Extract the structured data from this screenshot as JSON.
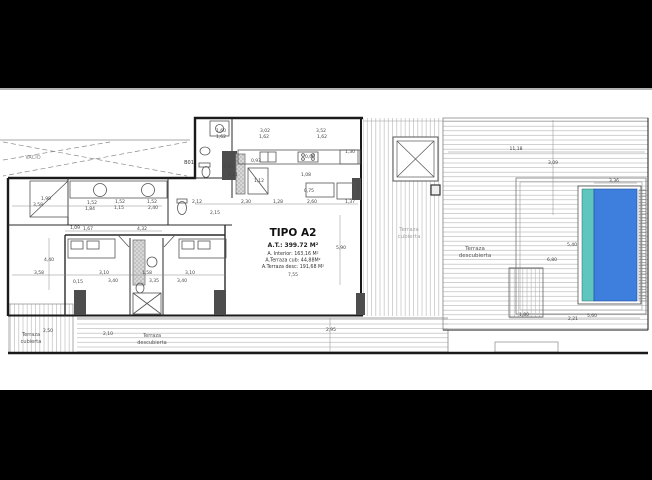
{
  "drawing": {
    "type": "architectural-floor-plan",
    "unit_label": "TIPO A2"
  },
  "colors": {
    "background": "#000000",
    "paper": "#ffffff",
    "wall": "#1a1a1a",
    "thin_line": "#777777",
    "hatch": "#b3b3b3",
    "dim_text": "#444444",
    "faint_text": "#a3a3a3",
    "pool_blue": "#3e7edd",
    "pool_teal": "#5fc6bf",
    "wall_block": "#4d4d4d"
  },
  "title_block": {
    "title": "TIPO A2",
    "total_area": "A.T.: 399.72 M²",
    "interior": "A. Interior: 163,16 M²",
    "terrace_covered": "A.Terraza cub: 44,88M²",
    "terrace_open": "A.Terraza desc: 191,68 M²"
  },
  "labels": [
    {
      "text": "VACIO",
      "x": 33,
      "y": 159,
      "size": 5,
      "color": "#888888",
      "weight": "normal"
    },
    {
      "text": "B01",
      "x": 189,
      "y": 164,
      "size": 5,
      "color": "#333333",
      "weight": "normal"
    },
    {
      "text": "Terraza",
      "x": 409,
      "y": 231,
      "size": 5.5,
      "color": "#a3a3a3",
      "weight": "normal"
    },
    {
      "text": "cubierta",
      "x": 409,
      "y": 238,
      "size": 5.5,
      "color": "#a3a3a3",
      "weight": "normal"
    },
    {
      "text": "Terraza",
      "x": 475,
      "y": 250,
      "size": 5.5,
      "color": "#555555",
      "weight": "normal"
    },
    {
      "text": "descubierta",
      "x": 475,
      "y": 257,
      "size": 5.5,
      "color": "#555555",
      "weight": "normal"
    },
    {
      "text": "Terraza",
      "x": 31,
      "y": 336,
      "size": 5,
      "color": "#555555",
      "weight": "normal"
    },
    {
      "text": "cubierta",
      "x": 31,
      "y": 343,
      "size": 5,
      "color": "#555555",
      "weight": "normal"
    },
    {
      "text": "Terraza",
      "x": 152,
      "y": 337,
      "size": 5,
      "color": "#555555",
      "weight": "normal"
    },
    {
      "text": "descubierta",
      "x": 152,
      "y": 344,
      "size": 5,
      "color": "#555555",
      "weight": "normal"
    },
    {
      "text": "TIPO A2",
      "x": 293,
      "y": 236,
      "size": 10.5,
      "color": "#111111",
      "weight": "bold"
    },
    {
      "text": "A.T.: 399.72 M²",
      "x": 293,
      "y": 247,
      "size": 6,
      "color": "#222222",
      "weight": "bold"
    },
    {
      "text": "A. Interior: 163,16 M²",
      "x": 293,
      "y": 255,
      "size": 4.8,
      "color": "#333333",
      "weight": "normal"
    },
    {
      "text": "A.Terraza cub: 44,88M²",
      "x": 293,
      "y": 261.5,
      "size": 4.8,
      "color": "#333333",
      "weight": "normal"
    },
    {
      "text": "A.Terraza desc: 191,68 M²",
      "x": 293,
      "y": 268,
      "size": 4.8,
      "color": "#333333",
      "weight": "normal"
    },
    {
      "text": "7,55",
      "x": 293,
      "y": 276,
      "size": 4.5,
      "color": "#444444",
      "weight": "normal"
    },
    {
      "text": "1,99",
      "x": 46,
      "y": 200,
      "size": 4.5,
      "color": "#444444",
      "weight": "normal"
    },
    {
      "text": "3,58",
      "x": 38,
      "y": 206,
      "size": 4.5,
      "color": "#444444",
      "weight": "normal"
    },
    {
      "text": "1,52",
      "x": 92,
      "y": 204,
      "size": 4.5,
      "color": "#444444",
      "weight": "normal"
    },
    {
      "text": "1,84",
      "x": 90,
      "y": 210,
      "size": 4.5,
      "color": "#444444",
      "weight": "normal"
    },
    {
      "text": "1,52",
      "x": 120,
      "y": 203,
      "size": 4.5,
      "color": "#444444",
      "weight": "normal"
    },
    {
      "text": "1,15",
      "x": 119,
      "y": 209,
      "size": 4.5,
      "color": "#444444",
      "weight": "normal"
    },
    {
      "text": "1,52",
      "x": 152,
      "y": 203,
      "size": 4.5,
      "color": "#444444",
      "weight": "normal"
    },
    {
      "text": "2,40",
      "x": 153,
      "y": 209,
      "size": 4.5,
      "color": "#444444",
      "weight": "normal"
    },
    {
      "text": "1,60",
      "x": 221,
      "y": 132,
      "size": 4.5,
      "color": "#444444",
      "weight": "normal"
    },
    {
      "text": "1,62",
      "x": 221,
      "y": 138,
      "size": 4.5,
      "color": "#444444",
      "weight": "normal"
    },
    {
      "text": "3,02",
      "x": 265,
      "y": 132,
      "size": 4.5,
      "color": "#444444",
      "weight": "normal"
    },
    {
      "text": "1,62",
      "x": 264,
      "y": 138,
      "size": 4.5,
      "color": "#444444",
      "weight": "normal"
    },
    {
      "text": "3,52",
      "x": 321,
      "y": 132,
      "size": 4.5,
      "color": "#444444",
      "weight": "normal"
    },
    {
      "text": "1,62",
      "x": 322,
      "y": 138,
      "size": 4.5,
      "color": "#444444",
      "weight": "normal"
    },
    {
      "text": "1,30",
      "x": 350,
      "y": 153,
      "size": 4.5,
      "color": "#444444",
      "weight": "normal"
    },
    {
      "text": "0,60",
      "x": 310,
      "y": 158,
      "size": 4.5,
      "color": "#444444",
      "weight": "normal"
    },
    {
      "text": "0,93",
      "x": 256,
      "y": 162,
      "size": 4.5,
      "color": "#444444",
      "weight": "normal"
    },
    {
      "text": "2,05",
      "x": 228,
      "y": 168,
      "size": 4.5,
      "color": "#444444",
      "weight": "normal"
    },
    {
      "text": "2,21",
      "x": 233,
      "y": 176,
      "size": 4.5,
      "color": "#444444",
      "weight": "normal"
    },
    {
      "text": "1,12",
      "x": 259,
      "y": 182,
      "size": 4.5,
      "color": "#444444",
      "weight": "normal"
    },
    {
      "text": "1,08",
      "x": 306,
      "y": 176,
      "size": 4.5,
      "color": "#444444",
      "weight": "normal"
    },
    {
      "text": "0,75",
      "x": 309,
      "y": 192,
      "size": 4.5,
      "color": "#444444",
      "weight": "normal"
    },
    {
      "text": "2,12",
      "x": 197,
      "y": 203,
      "size": 4.5,
      "color": "#444444",
      "weight": "normal"
    },
    {
      "text": "2,30",
      "x": 246,
      "y": 203,
      "size": 4.5,
      "color": "#444444",
      "weight": "normal"
    },
    {
      "text": "1,28",
      "x": 278,
      "y": 203,
      "size": 4.5,
      "color": "#444444",
      "weight": "normal"
    },
    {
      "text": "2,60",
      "x": 312,
      "y": 203,
      "size": 4.5,
      "color": "#444444",
      "weight": "normal"
    },
    {
      "text": "1,37",
      "x": 350,
      "y": 203,
      "size": 4.5,
      "color": "#444444",
      "weight": "normal"
    },
    {
      "text": "2,15",
      "x": 215,
      "y": 214,
      "size": 4.5,
      "color": "#444444",
      "weight": "normal"
    },
    {
      "text": "5,90",
      "x": 341,
      "y": 249,
      "size": 4.5,
      "color": "#444444",
      "weight": "normal"
    },
    {
      "text": "1,09",
      "x": 75,
      "y": 229,
      "size": 4.5,
      "color": "#444444",
      "weight": "normal"
    },
    {
      "text": "1,67",
      "x": 88,
      "y": 230,
      "size": 4.5,
      "color": "#444444",
      "weight": "normal"
    },
    {
      "text": "4,32",
      "x": 142,
      "y": 230,
      "size": 4.5,
      "color": "#444444",
      "weight": "normal"
    },
    {
      "text": "4,40",
      "x": 49,
      "y": 261,
      "size": 4.5,
      "color": "#444444",
      "weight": "normal"
    },
    {
      "text": "3,58",
      "x": 39,
      "y": 274,
      "size": 4.5,
      "color": "#444444",
      "weight": "normal"
    },
    {
      "text": "3,10",
      "x": 104,
      "y": 274,
      "size": 4.5,
      "color": "#444444",
      "weight": "normal"
    },
    {
      "text": "3,40",
      "x": 113,
      "y": 282,
      "size": 4.5,
      "color": "#444444",
      "weight": "normal"
    },
    {
      "text": "1,58",
      "x": 147,
      "y": 274,
      "size": 4.5,
      "color": "#444444",
      "weight": "normal"
    },
    {
      "text": "3,35",
      "x": 154,
      "y": 282,
      "size": 4.5,
      "color": "#444444",
      "weight": "normal"
    },
    {
      "text": "0,15",
      "x": 78,
      "y": 283,
      "size": 4.5,
      "color": "#444444",
      "weight": "normal"
    },
    {
      "text": "3,10",
      "x": 190,
      "y": 274,
      "size": 4.5,
      "color": "#444444",
      "weight": "normal"
    },
    {
      "text": "3,40",
      "x": 182,
      "y": 282,
      "size": 4.5,
      "color": "#444444",
      "weight": "normal"
    },
    {
      "text": "2,50",
      "x": 48,
      "y": 332,
      "size": 4.5,
      "color": "#444444",
      "weight": "normal"
    },
    {
      "text": "2,10",
      "x": 108,
      "y": 335,
      "size": 4.5,
      "color": "#444444",
      "weight": "normal"
    },
    {
      "text": "2,95",
      "x": 331,
      "y": 331,
      "size": 4.5,
      "color": "#444444",
      "weight": "normal"
    },
    {
      "text": "11,18",
      "x": 516,
      "y": 150,
      "size": 4.5,
      "color": "#444444",
      "weight": "normal"
    },
    {
      "text": "3,09",
      "x": 553,
      "y": 164,
      "size": 4.5,
      "color": "#444444",
      "weight": "normal"
    },
    {
      "text": "3,36",
      "x": 614,
      "y": 182,
      "size": 4.5,
      "color": "#444444",
      "weight": "normal"
    },
    {
      "text": "5,40",
      "x": 572,
      "y": 246,
      "size": 4.5,
      "color": "#444444",
      "weight": "normal"
    },
    {
      "text": "6,80",
      "x": 552,
      "y": 261,
      "size": 4.5,
      "color": "#444444",
      "weight": "normal"
    },
    {
      "text": "1,80",
      "x": 524,
      "y": 316,
      "size": 4.5,
      "color": "#444444",
      "weight": "normal"
    },
    {
      "text": "2,21",
      "x": 573,
      "y": 320,
      "size": 4.5,
      "color": "#444444",
      "weight": "normal"
    },
    {
      "text": "5,60",
      "x": 592,
      "y": 317,
      "size": 4.5,
      "color": "#444444",
      "weight": "normal"
    }
  ]
}
